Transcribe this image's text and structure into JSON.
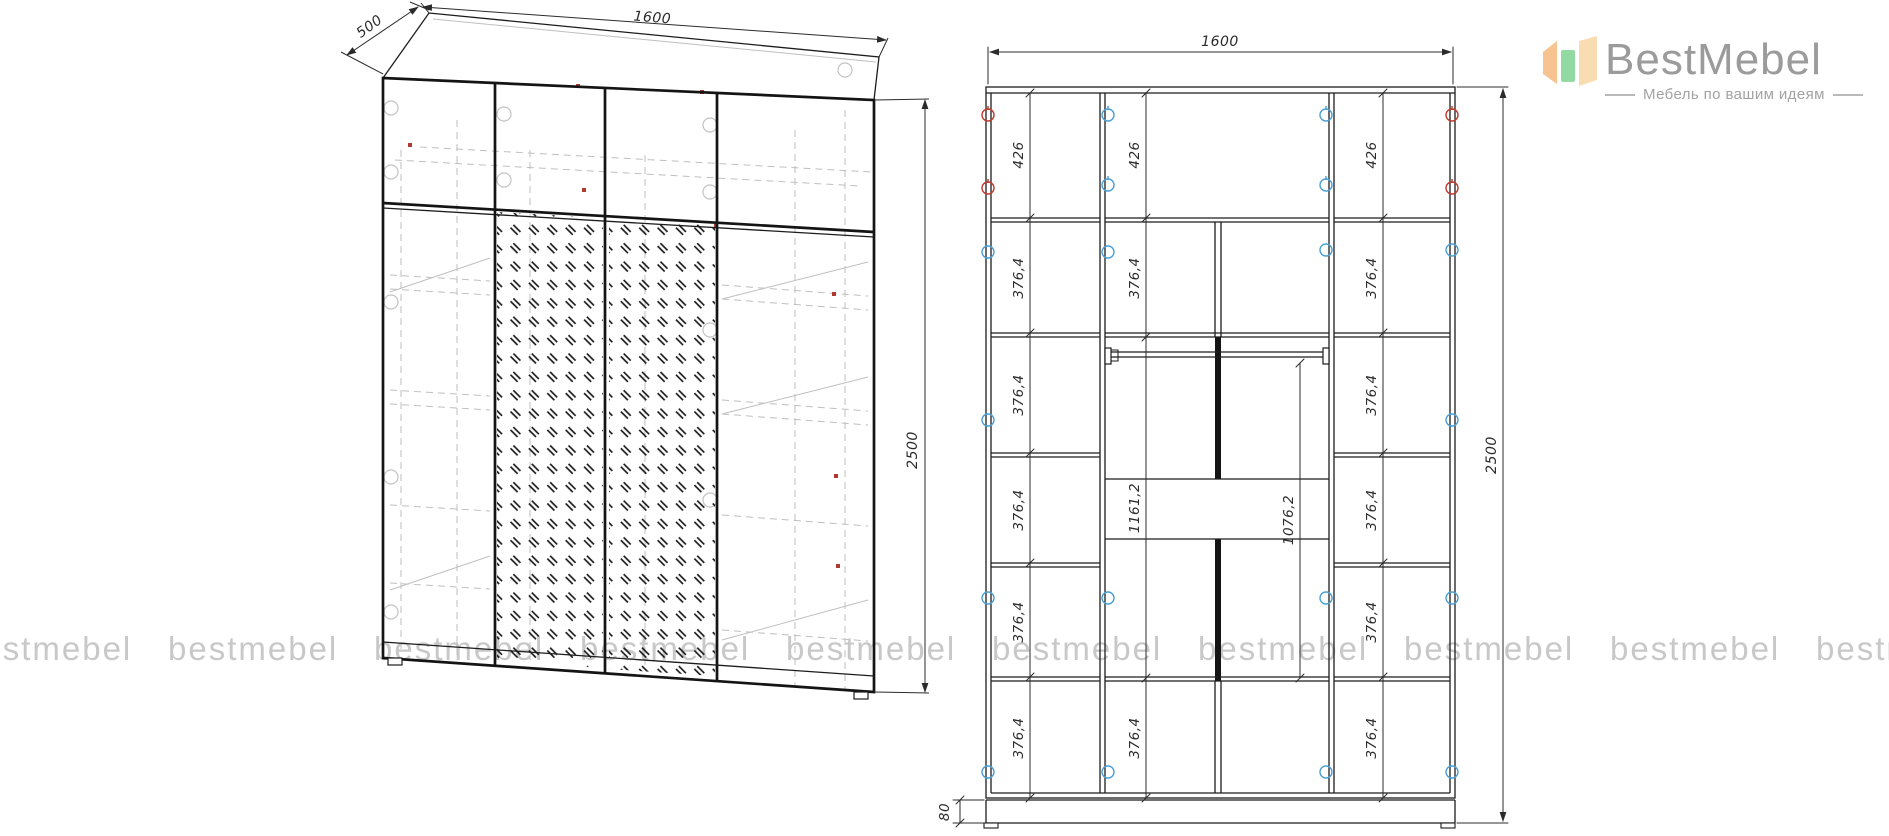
{
  "logo": {
    "brand": "BestMebel",
    "tagline": "Мебель по вашим идеям",
    "icon_colors": {
      "left_panel": "#f6c391",
      "middle_panel": "#92d9a2",
      "right_panel": "#fadcb2"
    },
    "brand_color": "#9b9b9b"
  },
  "watermark": {
    "text": "bestmebel",
    "color": "#c8c8c8"
  },
  "perspective_view": {
    "depth": "500",
    "width": "1600",
    "height": "2500"
  },
  "front_view": {
    "width": "1600",
    "height": "2500",
    "plinth_height": "80",
    "row_426": "426",
    "row_376": "376,4",
    "hang_1161": "1161,2",
    "hang_1076": "1076,2"
  },
  "colors": {
    "line": "#1c1c1c",
    "ghost_line": "#bfbfbf",
    "marker_red": "#c0392b",
    "marker_blue": "#4a9fd4",
    "watermark": "#c8c8c8"
  }
}
